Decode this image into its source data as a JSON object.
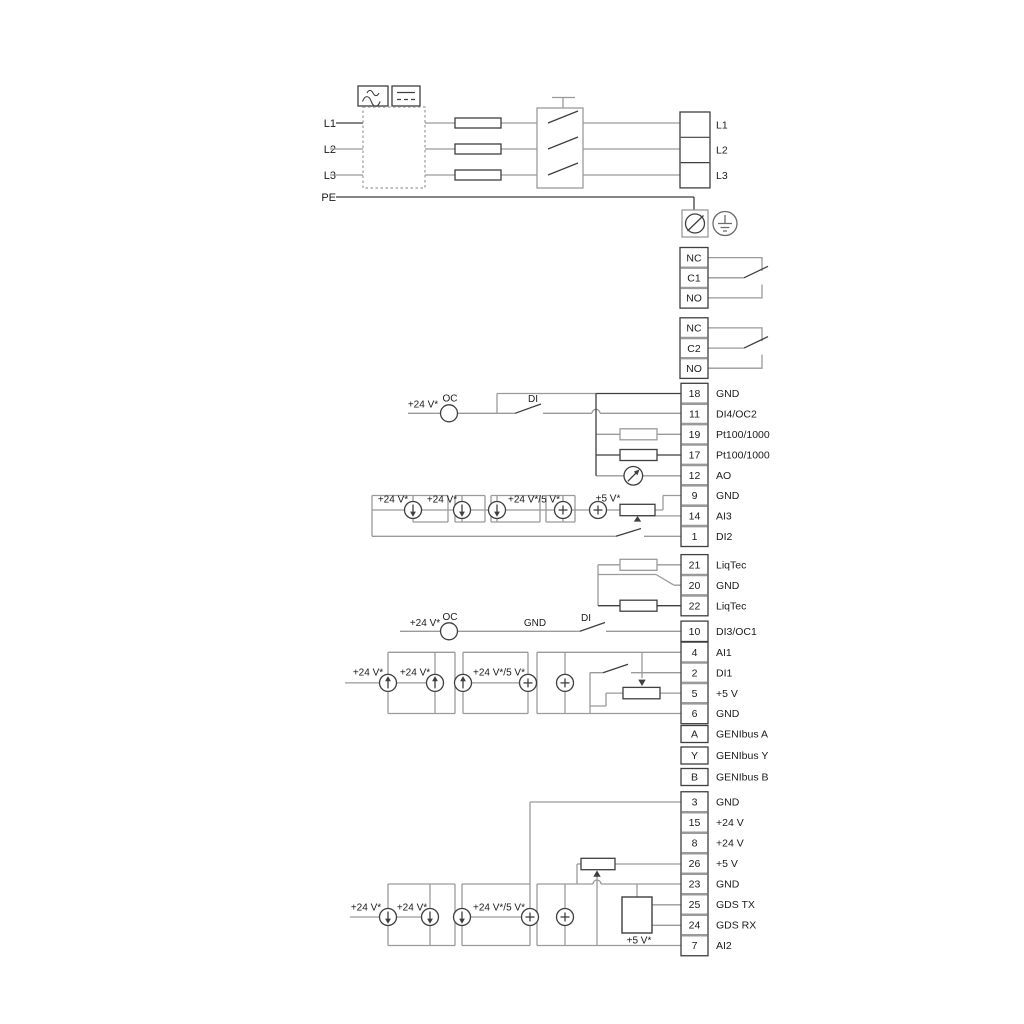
{
  "power": {
    "inputs": [
      "L1",
      "L2",
      "L3"
    ],
    "pe": "PE"
  },
  "strips": {
    "power": [
      {
        "num": "",
        "label": "L1"
      },
      {
        "num": "",
        "label": "L2"
      },
      {
        "num": "",
        "label": "L3"
      }
    ],
    "relay1": [
      {
        "num": "NC",
        "label": ""
      },
      {
        "num": "C1",
        "label": ""
      },
      {
        "num": "NO",
        "label": ""
      }
    ],
    "relay2": [
      {
        "num": "NC",
        "label": ""
      },
      {
        "num": "C2",
        "label": ""
      },
      {
        "num": "NO",
        "label": ""
      }
    ],
    "io1": [
      {
        "num": "18",
        "label": "GND"
      },
      {
        "num": "11",
        "label": "DI4/OC2"
      },
      {
        "num": "19",
        "label": "Pt100/1000"
      },
      {
        "num": "17",
        "label": "Pt100/1000"
      },
      {
        "num": "12",
        "label": "AO"
      },
      {
        "num": "9",
        "label": "GND"
      },
      {
        "num": "14",
        "label": "AI3"
      },
      {
        "num": "1",
        "label": "DI2"
      }
    ],
    "liqtec": [
      {
        "num": "21",
        "label": "LiqTec"
      },
      {
        "num": "20",
        "label": "GND"
      },
      {
        "num": "22",
        "label": "LiqTec"
      }
    ],
    "di3": [
      {
        "num": "10",
        "label": "DI3/OC1"
      }
    ],
    "ai1": [
      {
        "num": "4",
        "label": "AI1"
      },
      {
        "num": "2",
        "label": "DI1"
      },
      {
        "num": "5",
        "label": "+5 V"
      },
      {
        "num": "6",
        "label": "GND"
      }
    ],
    "genibus": [
      {
        "num": "A",
        "label": "GENIbus A"
      },
      {
        "num": "Y",
        "label": "GENIbus Y"
      },
      {
        "num": "B",
        "label": "GENIbus B"
      }
    ],
    "io2": [
      {
        "num": "3",
        "label": "GND"
      },
      {
        "num": "15",
        "label": "+24 V"
      },
      {
        "num": "8",
        "label": "+24 V"
      },
      {
        "num": "26",
        "label": "+5 V"
      },
      {
        "num": "23",
        "label": "GND"
      },
      {
        "num": "25",
        "label": "GDS TX"
      },
      {
        "num": "24",
        "label": "GDS RX"
      },
      {
        "num": "7",
        "label": "AI2"
      }
    ]
  },
  "annotations": {
    "oc": "OC",
    "di": "DI",
    "gnd": "GND",
    "v24": "+24 V*",
    "v24_5": "+24 V*/5 V*",
    "v5": "+5 V*"
  },
  "colors": {
    "wire": "#9a9a9a",
    "dark": "#3f3f3f",
    "text": "#1b1b1b"
  }
}
